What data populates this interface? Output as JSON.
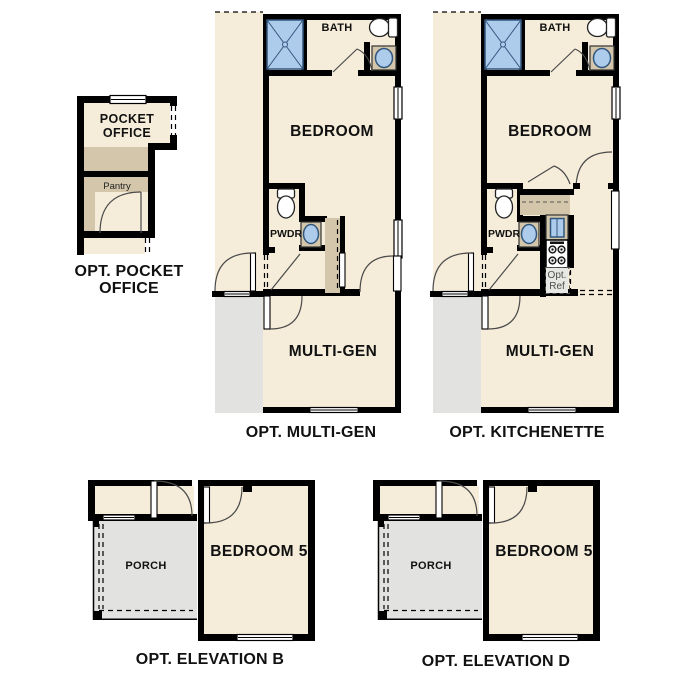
{
  "plans": {
    "pocket_office": {
      "room_label_line1": "POCKET",
      "room_label_line2": "OFFICE",
      "pantry_label": "Pantry",
      "caption_line1": "OPT. POCKET",
      "caption_line2": "OFFICE"
    },
    "multi_gen": {
      "bath_label": "BATH",
      "bedroom_label": "BEDROOM",
      "pwdr_label": "PWDR",
      "room_label": "MULTI-GEN",
      "caption": "OPT. MULTI-GEN"
    },
    "kitchenette": {
      "bath_label": "BATH",
      "bedroom_label": "BEDROOM",
      "pwdr_label": "PWDR",
      "room_label": "MULTI-GEN",
      "opt_ref_line1": "Opt.",
      "opt_ref_line2": "Ref",
      "caption": "OPT. KITCHENETTE"
    },
    "elevation_b": {
      "porch_label": "PORCH",
      "bedroom_label": "BEDROOM 5",
      "caption": "OPT. ELEVATION B"
    },
    "elevation_d": {
      "porch_label": "PORCH",
      "bedroom_label": "BEDROOM 5",
      "caption": "OPT. ELEVATION D"
    }
  },
  "colors": {
    "floor": "#f5edda",
    "counter": "#d3c6aa",
    "porch_gray": "#e2e2e0",
    "wall": "#000000",
    "fixture_blue": "#adcbea",
    "fixture_blue_dark": "#33567e",
    "door_arc": "#4a4a4a",
    "muted_text": "#4f4f4f",
    "opt_ref_bg": "#e7e7e4"
  }
}
